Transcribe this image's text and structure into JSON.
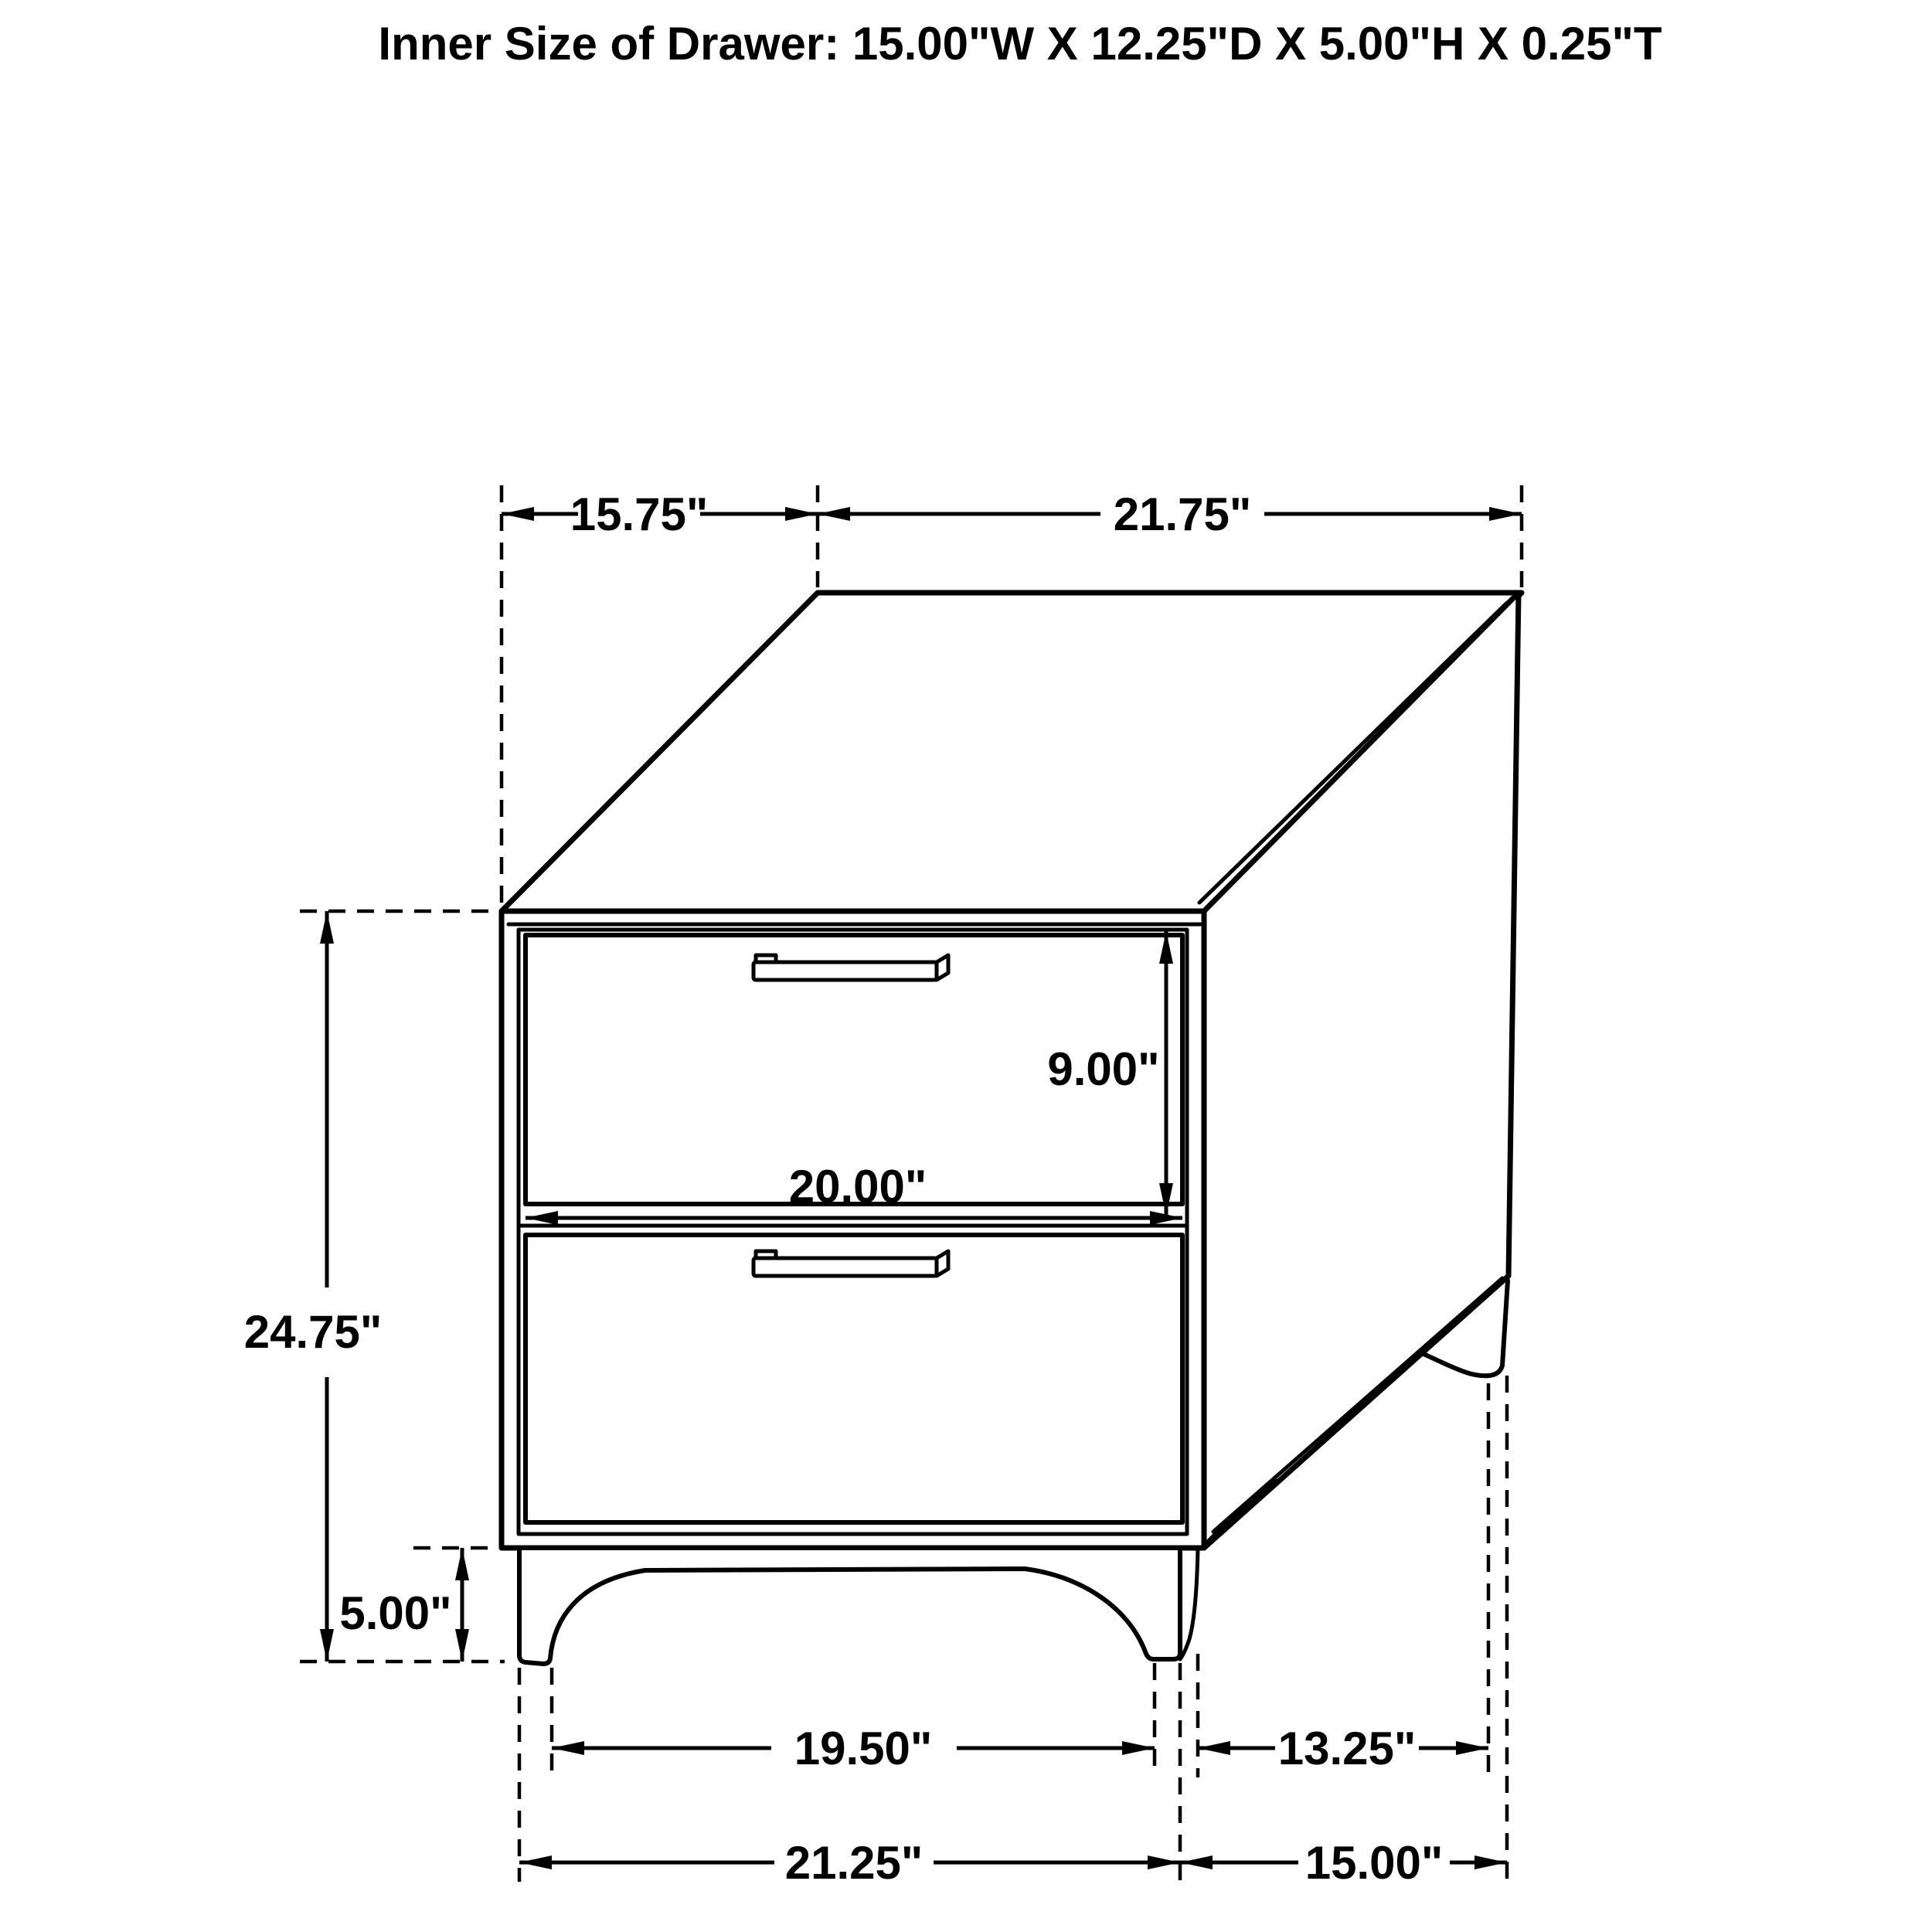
{
  "title": "Inner Size of Drawer: 15.00\"W X 12.25\"D X 5.00\"H X 0.25\"T",
  "drawing": {
    "subject": "two-drawer nightstand isometric technical drawing",
    "line_color": "#000000",
    "background_color": "#ffffff"
  },
  "dims": {
    "top_depth": "15.75\"",
    "top_width": "21.75\"",
    "overall_height": "24.75\"",
    "drawer_opening_height": "9.00\"",
    "drawer_front_width": "20.00\"",
    "leg_height": "5.00\"",
    "front_leg_inner_span": "19.50\"",
    "side_leg_inner_span": "13.25\"",
    "front_floor_width": "21.25\"",
    "side_floor_depth": "15.00\""
  }
}
